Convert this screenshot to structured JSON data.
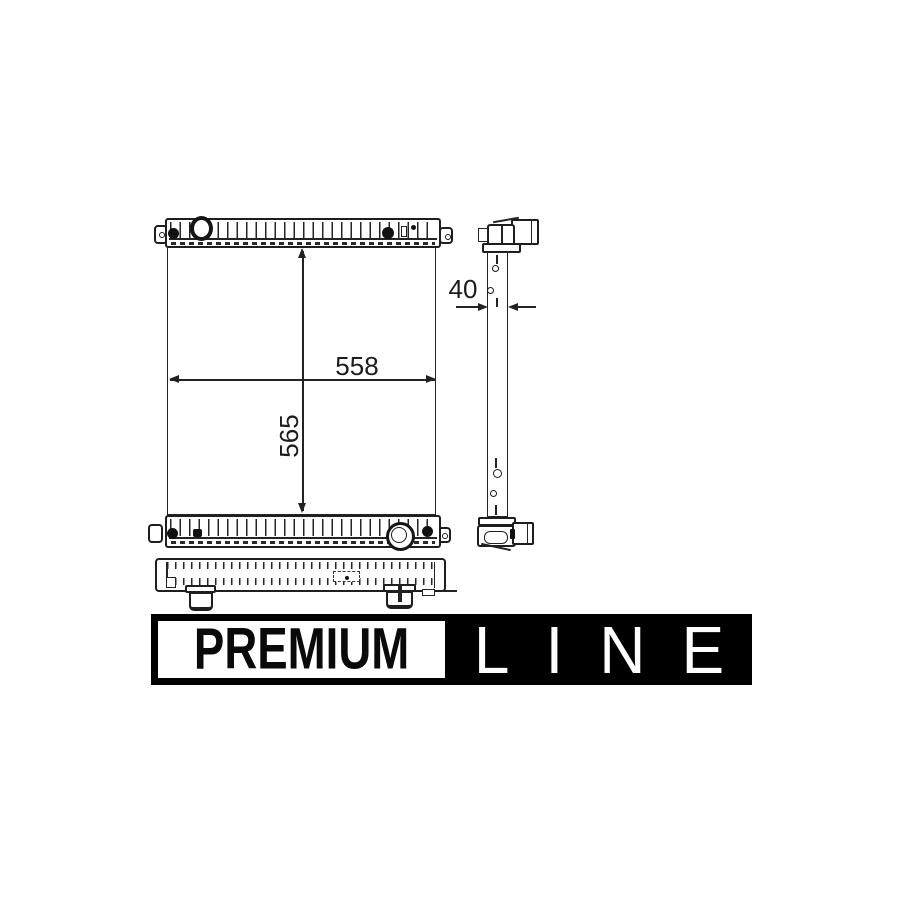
{
  "drawing": {
    "title": "radiator-technical-drawing",
    "dim_width": "558",
    "dim_height": "565",
    "dim_depth": "40"
  },
  "branding": {
    "premium": "PREMIUM",
    "line": "LINE",
    "banner_bg": "#000000",
    "banner_fg": "#ffffff"
  },
  "colors": {
    "line_color": "#232323",
    "background": "#ffffff"
  }
}
